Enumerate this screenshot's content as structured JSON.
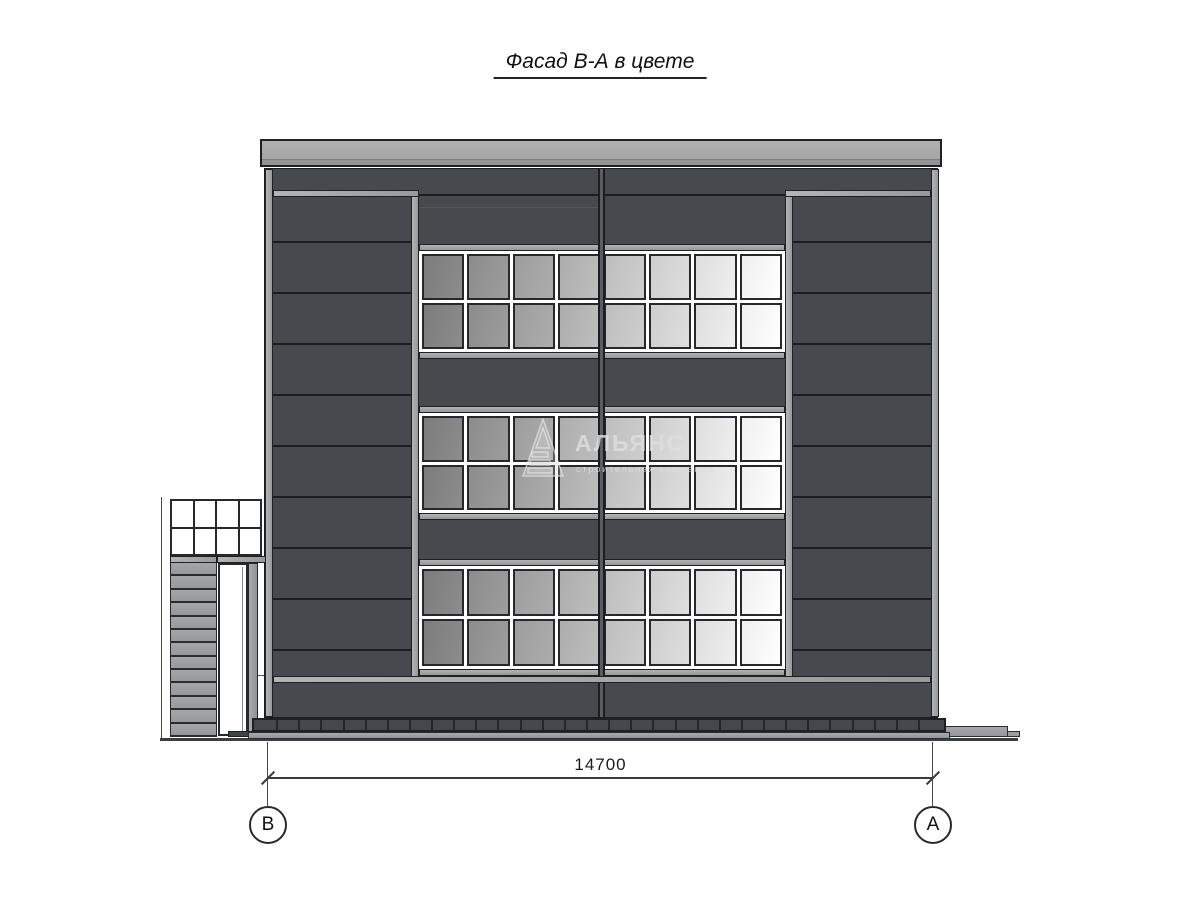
{
  "title": "Фасад В-А в цвете",
  "watermark": {
    "name": "АЛЬЯНС",
    "subtitle": "строительная компания"
  },
  "dimension": {
    "value": "14700",
    "axis_left": "В",
    "axis_right": "А"
  },
  "structure": {
    "colors": {
      "wall_dark": "#46494e",
      "panel_line": "#1b1d20",
      "trim_light": "#a2a4a6",
      "roof": "#a8a8a8",
      "plinth": "#44474b",
      "pane_gradient_start": "#7c7c7c",
      "pane_gradient_end": "#ffffff"
    },
    "walls": {
      "divider_ys": [
        72,
        123,
        174,
        225,
        276,
        327,
        378,
        429,
        480
      ],
      "left_x": 8,
      "right_x": 528,
      "width": 138
    },
    "window_bands": [
      {
        "top": 75,
        "height": 115
      },
      {
        "top": 237,
        "height": 114
      },
      {
        "top": 390,
        "height": 117
      }
    ],
    "panes": {
      "cols": 8,
      "rows": 2
    },
    "annex": {
      "canopy_cols": 4,
      "canopy_rows": 2,
      "stair_steps": 13
    },
    "plinth": {
      "ticks": 31
    }
  }
}
